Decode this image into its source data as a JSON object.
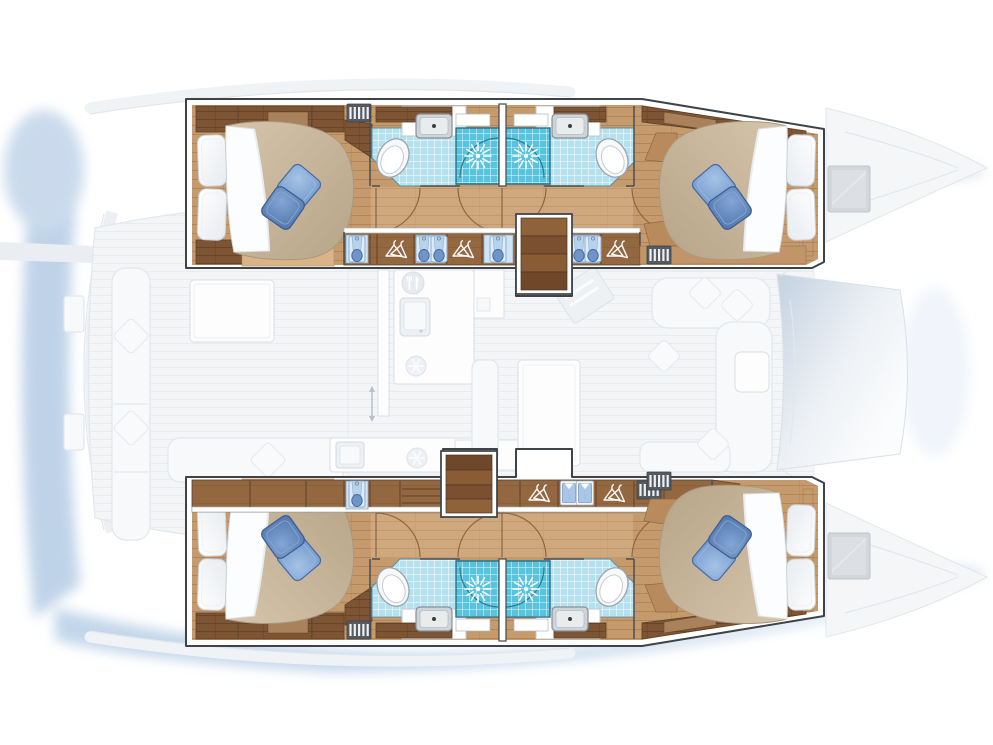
{
  "meta": {
    "title": "Catamaran 4-cabin layout plan",
    "view": "overhead deck plan",
    "highlight": "hull accommodations shown in colour, main deck and exterior dimmed"
  },
  "counts": {
    "double_cabins": 4,
    "bathrooms": 4,
    "showers": 4,
    "companionway_stairs": 2,
    "deck_hatches": 2
  },
  "regions": {
    "hull_top": {
      "label": "Port hull accommodation"
    },
    "hull_bottom": {
      "label": "Starboard hull accommodation"
    },
    "cabin_top_aft": {
      "label": "Aft double cabin, port hull"
    },
    "cabin_top_fwd": {
      "label": "Forward double cabin, port hull"
    },
    "bath_top_aft": {
      "label": "Aft shower room, port hull"
    },
    "bath_top_fwd": {
      "label": "Forward shower room, port hull"
    },
    "corridor_top": {
      "label": "Companionway corridor, port hull"
    },
    "wardrobes_top": {
      "label": "Wardrobe lockers, port hull"
    },
    "stairs_top": {
      "label": "Companionway steps, port hull"
    },
    "cabin_bottom_aft": {
      "label": "Aft double cabin, starboard hull"
    },
    "cabin_bottom_fwd": {
      "label": "Forward double cabin, starboard hull"
    },
    "bath_bottom_aft": {
      "label": "Aft shower room, starboard hull"
    },
    "bath_bottom_fwd": {
      "label": "Forward shower room, starboard hull"
    },
    "corridor_bottom": {
      "label": "Companionway corridor, starboard hull"
    },
    "wardrobes_bottom": {
      "label": "Wardrobe lockers, starboard hull"
    },
    "stairs_bottom": {
      "label": "Companionway steps, starboard hull"
    },
    "saloon": {
      "label": "Saloon and galley (dimmed)"
    },
    "cockpit": {
      "label": "Aft cockpit (dimmed)"
    },
    "bow_lounge": {
      "label": "Forward cockpit between bows (dimmed)"
    },
    "foredeck_top": {
      "label": "Port foredeck with hatch (dimmed)"
    },
    "foredeck_bottom": {
      "label": "Starboard foredeck with hatch (dimmed)"
    }
  },
  "icons": [
    "bed-double-icon",
    "pillow-icon",
    "throw-pillow-icon",
    "toilet-icon",
    "washbasin-icon",
    "shower-rose-icon",
    "shower-door-arc",
    "door-swing-arc",
    "clothes-hanger-icon",
    "hanging-towel-icon",
    "folded-shirt-icon",
    "vent-grille-icon",
    "companionway-stairs-icon",
    "fridge-snowflake-icon",
    "galley-sink-icon",
    "cutlery-icon",
    "deck-hatch-icon",
    "sliding-door-arrow-icon"
  ],
  "colors": {
    "wood_floor": "#c59a6d",
    "wood_plank_line": "#b2855a",
    "wood_dark": "#7e5534",
    "wood_row": "#936740",
    "tile": "#b5e0ee",
    "shower": "#57c3dc",
    "duvet": "#c9b79c",
    "pillow_blue_light": "#7fa3d4",
    "pillow_blue_dark": "#5a80b5",
    "wall_outline": "#3f4347",
    "water_shadow": "#b9cfe6",
    "faded_fill": "#f3f5f7",
    "faded_line": "#e2e7ec"
  }
}
